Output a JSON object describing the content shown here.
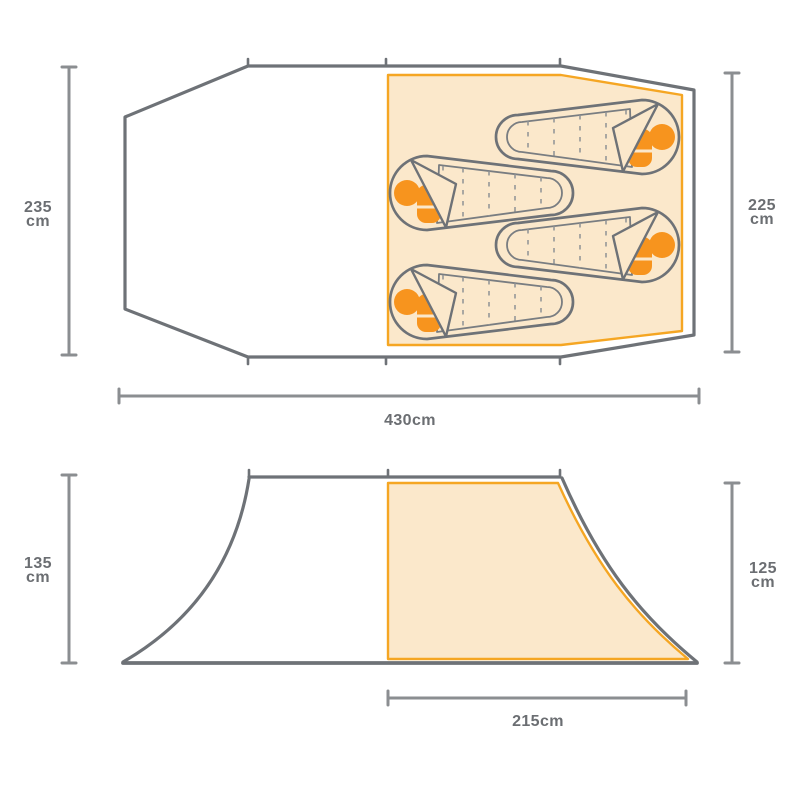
{
  "diagram": {
    "kind": "tent-dimensions-diagram",
    "views": {
      "floor_plan": {
        "sleeping_bag_count": 4,
        "dim_left": {
          "value": "235",
          "unit": "cm"
        },
        "dim_right": {
          "value": "225",
          "unit": "cm"
        },
        "dim_width": {
          "value": "430cm"
        }
      },
      "side_profile": {
        "dim_left": {
          "value": "135",
          "unit": "cm"
        },
        "dim_right": {
          "value": "125",
          "unit": "cm"
        },
        "dim_inner_width": {
          "value": "215cm"
        }
      }
    },
    "colors": {
      "outline_gray": "#6E7277",
      "dimension_gray": "#8B8E91",
      "label_text": "#6B6E72",
      "sleeping_area_fill": "#FBE8CB",
      "sleeping_area_stroke": "#F5A623",
      "pillow_orange": "#F7941E"
    }
  }
}
